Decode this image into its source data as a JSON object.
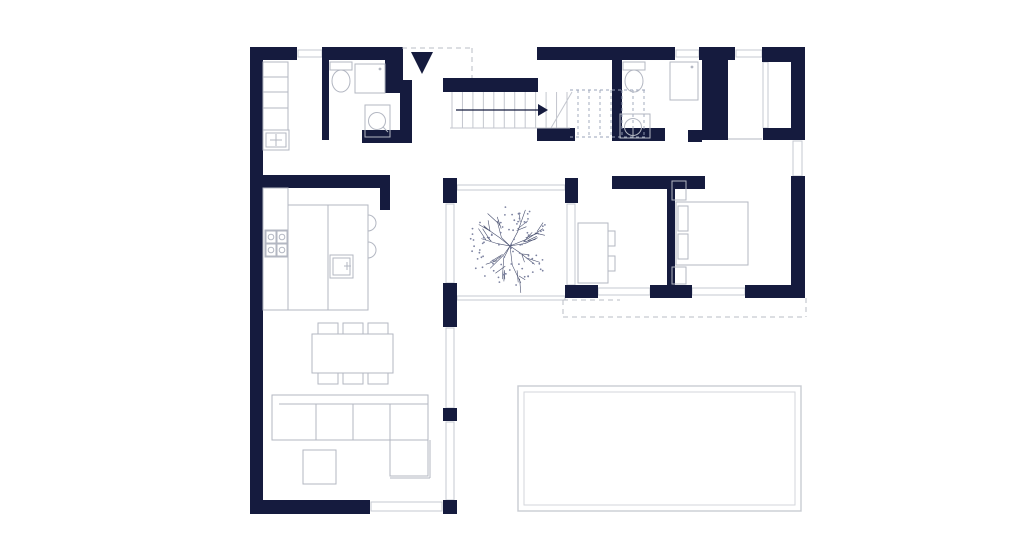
{
  "meta": {
    "title": "house-ground-floor-plan",
    "canvas": {
      "w": 1024,
      "h": 551
    },
    "colors": {
      "wall": "#151b3e",
      "furniture_line": "#b3b7c2",
      "glazing_line": "#c6c9d1",
      "dashed_line": "#b9bdc6",
      "pool_line": "#c9ccd2",
      "tree_line": "#4a5170",
      "background": "#ffffff"
    }
  },
  "plan": {
    "walls": [
      [
        250,
        47,
        13,
        467,
        "left-exterior-wall"
      ],
      [
        250,
        47,
        47,
        13,
        "top-wall-a"
      ],
      [
        322,
        47,
        81,
        13,
        "top-wall-b"
      ],
      [
        390,
        60,
        13,
        28,
        "entry-jamb"
      ],
      [
        443,
        78,
        95,
        14,
        "stairwell-north-wall"
      ],
      [
        537,
        47,
        138,
        13,
        "top-wall-c"
      ],
      [
        699,
        47,
        36,
        13,
        "top-wall-d"
      ],
      [
        762,
        47,
        43,
        15,
        "wardrobe-top-arm"
      ],
      [
        791,
        60,
        14,
        80,
        "right-wall-upper"
      ],
      [
        763,
        128,
        28,
        12,
        "wardrobe-bottom-arm"
      ],
      [
        791,
        176,
        14,
        122,
        "right-wall-lower"
      ],
      [
        702,
        60,
        26,
        80,
        "closet-pier"
      ],
      [
        322,
        60,
        7,
        80,
        "utility-bath-partition"
      ],
      [
        385,
        60,
        17,
        20,
        "bath1-east-wall-upper"
      ],
      [
        385,
        80,
        27,
        13,
        "bath1-east-step"
      ],
      [
        400,
        93,
        12,
        44,
        "bath1-east-wall-lower"
      ],
      [
        362,
        130,
        50,
        13,
        "bath1-south-wall"
      ],
      [
        537,
        128,
        38,
        13,
        "hall-wall-a"
      ],
      [
        612,
        128,
        53,
        13,
        "bath2-south-wall"
      ],
      [
        688,
        130,
        14,
        12,
        "bath2-south-east"
      ],
      [
        612,
        60,
        10,
        68,
        "bath2-west-wall"
      ],
      [
        263,
        175,
        127,
        13,
        "kitchen-north-wall"
      ],
      [
        380,
        188,
        10,
        22,
        "kitchen-wall-stub"
      ],
      [
        443,
        178,
        14,
        25,
        "courtyard-west-post-a"
      ],
      [
        443,
        283,
        14,
        44,
        "courtyard-west-post-b"
      ],
      [
        443,
        408,
        14,
        13,
        "courtyard-west-post-c"
      ],
      [
        443,
        500,
        14,
        14,
        "living-southeast-post"
      ],
      [
        250,
        500,
        120,
        14,
        "south-wall"
      ],
      [
        565,
        178,
        13,
        25,
        "courtyard-east-post"
      ],
      [
        612,
        176,
        93,
        13,
        "bedroom-north-wall"
      ],
      [
        667,
        189,
        8,
        109,
        "bedroom-divider-wall"
      ],
      [
        565,
        285,
        33,
        13,
        "bedroom-south-wall-a"
      ],
      [
        650,
        285,
        42,
        13,
        "bedroom-south-wall-b"
      ],
      [
        745,
        285,
        60,
        13,
        "bedroom-south-wall-c"
      ]
    ],
    "windows": [
      [
        298,
        50,
        24,
        7,
        "window-top-1"
      ],
      [
        676,
        50,
        23,
        7,
        "window-top-2"
      ],
      [
        736,
        50,
        26,
        7,
        "window-top-3"
      ],
      [
        793,
        141,
        9,
        35,
        "window-right"
      ],
      [
        598,
        288,
        52,
        7,
        "window-bedroom-south-1"
      ],
      [
        692,
        288,
        53,
        7,
        "window-bedroom-south-2"
      ],
      [
        446,
        204,
        8,
        79,
        "glazing-courtyard-west"
      ],
      [
        446,
        328,
        8,
        80,
        "glazing-living-east-1"
      ],
      [
        446,
        422,
        8,
        78,
        "glazing-living-east-2"
      ],
      [
        567,
        204,
        8,
        81,
        "glazing-courtyard-east"
      ],
      [
        371,
        502,
        71,
        9,
        "window-south"
      ],
      [
        457,
        185,
        108,
        5,
        "glazing-courtyard-north"
      ],
      [
        457,
        296,
        108,
        4,
        "courtyard-south-edge"
      ],
      [
        763,
        62,
        5,
        66,
        "wardrobe-niche-glazing"
      ]
    ],
    "furniture": [
      {
        "t": "rect",
        "b": [
          263,
          62,
          25,
          46
        ],
        "n": "utility-shelf-a"
      },
      {
        "t": "line",
        "b": [
          263,
          77,
          288,
          77
        ],
        "n": "utility-shelf-line-1"
      },
      {
        "t": "line",
        "b": [
          263,
          92,
          288,
          92
        ],
        "n": "utility-shelf-line-2"
      },
      {
        "t": "rect",
        "b": [
          263,
          108,
          25,
          22
        ],
        "n": "utility-shelf-b"
      },
      {
        "t": "rect",
        "b": [
          263,
          130,
          26,
          20
        ],
        "n": "utility-sink-unit"
      },
      {
        "t": "rect",
        "b": [
          266,
          133,
          20,
          14
        ],
        "n": "utility-sink-basin"
      },
      {
        "t": "line",
        "b": [
          270,
          140,
          282,
          140
        ],
        "n": "utility-tap-h"
      },
      {
        "t": "line",
        "b": [
          276,
          134,
          276,
          146
        ],
        "n": "utility-tap-v"
      },
      {
        "t": "rect",
        "b": [
          330,
          62,
          22,
          8
        ],
        "n": "toilet1-tank"
      },
      {
        "t": "ellipse",
        "b": [
          341,
          81,
          9,
          11
        ],
        "n": "toilet1-bowl"
      },
      {
        "t": "rect",
        "b": [
          355,
          64,
          30,
          29
        ],
        "n": "shower1-tray"
      },
      {
        "t": "dot",
        "b": [
          380,
          69,
          1.4
        ],
        "n": "shower1-head"
      },
      {
        "t": "rect",
        "b": [
          365,
          105,
          25,
          32
        ],
        "n": "washer"
      },
      {
        "t": "circle",
        "b": [
          377,
          121,
          8.5
        ],
        "n": "washer-drum"
      },
      {
        "t": "line",
        "b": [
          383,
          127,
          388,
          132
        ],
        "n": "washer-tick"
      },
      {
        "t": "rect",
        "b": [
          623,
          62,
          22,
          8
        ],
        "n": "toilet2-tank"
      },
      {
        "t": "ellipse",
        "b": [
          634,
          81,
          9,
          11
        ],
        "n": "toilet2-bowl"
      },
      {
        "t": "rect",
        "b": [
          620,
          114,
          30,
          24
        ],
        "n": "vanity2"
      },
      {
        "t": "circle",
        "b": [
          633,
          127,
          8.5
        ],
        "n": "sink2-basin"
      },
      {
        "t": "line",
        "b": [
          633,
          127,
          633,
          138
        ],
        "n": "sink2-tap"
      },
      {
        "t": "rect",
        "b": [
          670,
          62,
          28,
          38
        ],
        "n": "shower2-tray"
      },
      {
        "t": "dot",
        "b": [
          692,
          67,
          1.4
        ],
        "n": "shower2-head"
      },
      {
        "t": "line",
        "b": [
          728,
          139,
          762,
          139
        ],
        "n": "wardrobe-niche-floor-line"
      },
      {
        "t": "rect",
        "b": [
          263,
          188,
          25,
          122
        ],
        "n": "kitchen-counter"
      },
      {
        "t": "rect",
        "b": [
          265,
          230,
          23,
          27
        ],
        "n": "cooktop"
      },
      {
        "t": "rect",
        "b": [
          266,
          231,
          10,
          12
        ],
        "n": "burner-frame-1"
      },
      {
        "t": "rect",
        "b": [
          277,
          231,
          10,
          12
        ],
        "n": "burner-frame-2"
      },
      {
        "t": "rect",
        "b": [
          266,
          244,
          10,
          12
        ],
        "n": "burner-frame-3"
      },
      {
        "t": "rect",
        "b": [
          277,
          244,
          10,
          12
        ],
        "n": "burner-frame-4"
      },
      {
        "t": "circle",
        "b": [
          271,
          237,
          2.8
        ],
        "n": "burner-1"
      },
      {
        "t": "circle",
        "b": [
          282,
          237,
          2.8
        ],
        "n": "burner-2"
      },
      {
        "t": "circle",
        "b": [
          271,
          250,
          2.8
        ],
        "n": "burner-3"
      },
      {
        "t": "circle",
        "b": [
          282,
          250,
          2.8
        ],
        "n": "burner-4"
      },
      {
        "t": "rect",
        "b": [
          288,
          205,
          80,
          105
        ],
        "n": "kitchen-island"
      },
      {
        "t": "line",
        "b": [
          328,
          205,
          328,
          310
        ],
        "n": "island-divider"
      },
      {
        "t": "rect",
        "b": [
          330,
          255,
          23,
          23
        ],
        "n": "island-sink"
      },
      {
        "t": "rect",
        "b": [
          333,
          258,
          17,
          17
        ],
        "n": "island-sink-basin"
      },
      {
        "t": "line",
        "b": [
          344,
          266,
          351,
          266
        ],
        "n": "island-tap-h"
      },
      {
        "t": "line",
        "b": [
          347,
          262,
          347,
          270
        ],
        "n": "island-tap-v"
      },
      {
        "t": "path",
        "d": "M368 215 a8 8 0 1 1 0 16",
        "n": "bar-stool-1"
      },
      {
        "t": "path",
        "d": "M368 242 a8 8 0 1 1 0 16",
        "n": "bar-stool-2"
      },
      {
        "t": "rect",
        "b": [
          312,
          334,
          81,
          39
        ],
        "n": "dining-table"
      },
      {
        "t": "rect",
        "b": [
          318,
          323,
          20,
          11
        ],
        "n": "dining-chair-1"
      },
      {
        "t": "rect",
        "b": [
          343,
          323,
          20,
          11
        ],
        "n": "dining-chair-2"
      },
      {
        "t": "rect",
        "b": [
          368,
          323,
          20,
          11
        ],
        "n": "dining-chair-3"
      },
      {
        "t": "rect",
        "b": [
          318,
          373,
          20,
          11
        ],
        "n": "dining-chair-4"
      },
      {
        "t": "rect",
        "b": [
          343,
          373,
          20,
          11
        ],
        "n": "dining-chair-5"
      },
      {
        "t": "rect",
        "b": [
          368,
          373,
          20,
          11
        ],
        "n": "dining-chair-6"
      },
      {
        "t": "rect",
        "b": [
          272,
          395,
          156,
          45
        ],
        "n": "sofa-body"
      },
      {
        "t": "line",
        "b": [
          279,
          404,
          428,
          404
        ],
        "n": "sofa-back-line"
      },
      {
        "t": "line",
        "b": [
          316,
          404,
          316,
          440
        ],
        "n": "sofa-seam-1"
      },
      {
        "t": "line",
        "b": [
          353,
          404,
          353,
          440
        ],
        "n": "sofa-seam-2"
      },
      {
        "t": "line",
        "b": [
          390,
          404,
          390,
          440
        ],
        "n": "sofa-seam-3"
      },
      {
        "t": "rect",
        "b": [
          390,
          440,
          38,
          36
        ],
        "n": "sofa-chaise"
      },
      {
        "t": "line",
        "b": [
          430,
          440,
          430,
          478
        ],
        "n": "sofa-chaise-outer-v"
      },
      {
        "t": "line",
        "b": [
          390,
          478,
          430,
          478
        ],
        "n": "sofa-chaise-outer-h"
      },
      {
        "t": "rect",
        "b": [
          303,
          450,
          33,
          34
        ],
        "n": "coffee-table"
      },
      {
        "t": "rect",
        "b": [
          676,
          202,
          72,
          63
        ],
        "n": "bed"
      },
      {
        "t": "rect",
        "b": [
          678,
          206,
          10,
          25
        ],
        "n": "bed-pillow-1"
      },
      {
        "t": "rect",
        "b": [
          678,
          234,
          10,
          25
        ],
        "n": "bed-pillow-2"
      },
      {
        "t": "rect",
        "b": [
          672,
          181,
          14,
          19
        ],
        "n": "nightstand-1"
      },
      {
        "t": "rect",
        "b": [
          672,
          267,
          14,
          17
        ],
        "n": "nightstand-2"
      },
      {
        "t": "rect",
        "b": [
          578,
          223,
          30,
          60
        ],
        "n": "dresser"
      },
      {
        "t": "rect",
        "b": [
          608,
          231,
          7,
          15
        ],
        "n": "dresser-knob-1"
      },
      {
        "t": "rect",
        "b": [
          608,
          256,
          7,
          15
        ],
        "n": "dresser-knob-2"
      }
    ],
    "stairs": {
      "solid": {
        "x0": 452,
        "x1": 567,
        "y0": 92,
        "y1": 128,
        "count": 12
      },
      "base_line": [
        450,
        128,
        570,
        128
      ],
      "break_line": [
        551,
        128,
        572,
        92
      ],
      "dashed": {
        "x0": 578,
        "x1": 644,
        "y0": 90,
        "y1": 137,
        "count": 7
      },
      "dashed_rails": [
        [
          570,
          90,
          647,
          90
        ],
        [
          570,
          137,
          647,
          137
        ]
      ],
      "arrow_line": [
        456,
        110,
        540,
        110
      ],
      "arrow_head": [
        [
          548,
          110
        ],
        [
          538,
          104
        ],
        [
          538,
          116
        ]
      ]
    },
    "dashes": [
      [
        402,
        48,
        472,
        48,
        "entry-canopy-dash-h"
      ],
      [
        472,
        48,
        472,
        78,
        "entry-canopy-dash-v"
      ],
      [
        563,
        300,
        563,
        317,
        "terrace-dash-w"
      ],
      [
        563,
        300,
        620,
        300,
        "terrace-dash-top"
      ],
      [
        563,
        317,
        806,
        317,
        "terrace-dash-s"
      ],
      [
        806,
        298,
        806,
        317,
        "terrace-dash-e"
      ]
    ],
    "entry_arrow": [
      [
        411,
        52
      ],
      [
        433,
        52
      ],
      [
        422,
        74
      ]
    ],
    "pool": {
      "outer": [
        518,
        386,
        283,
        125
      ],
      "inner": [
        524,
        392,
        271,
        113
      ]
    },
    "tree": {
      "cx": 510,
      "cy": 246,
      "r": 40,
      "seed": 7,
      "branches": 10,
      "twigs_per_branch": 3,
      "dots": 85
    }
  }
}
